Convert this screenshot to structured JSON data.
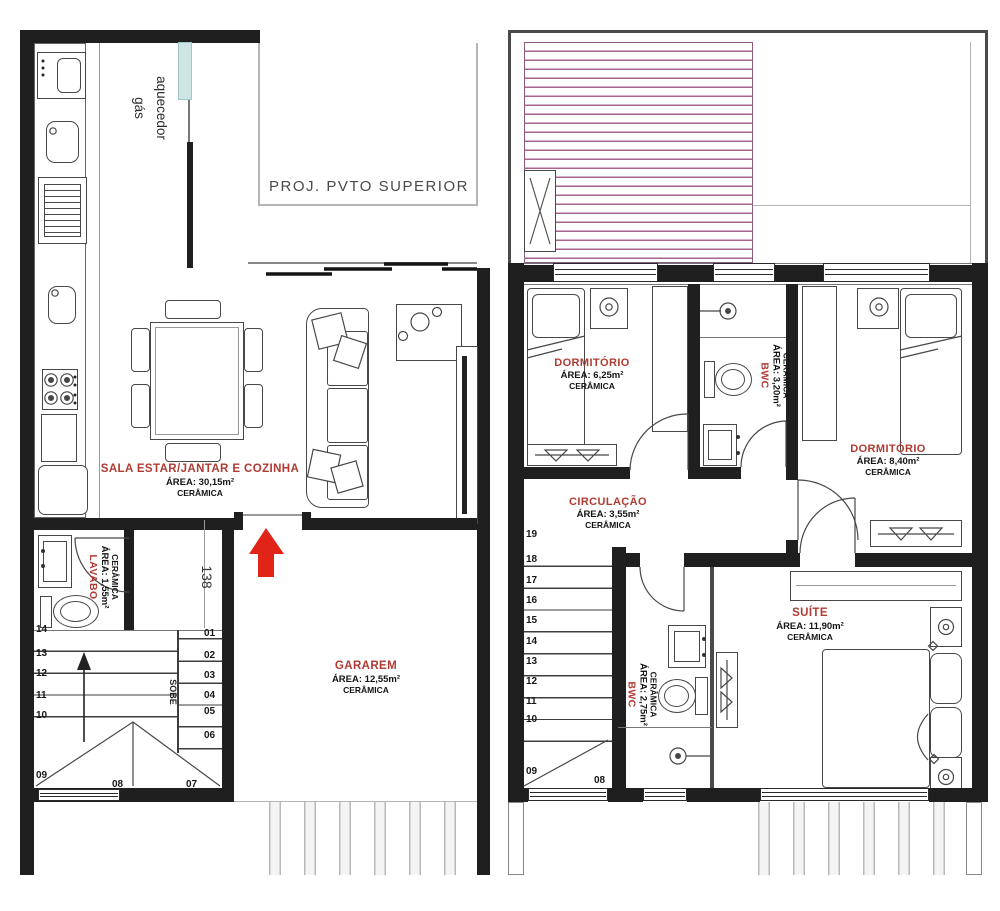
{
  "palette": {
    "label_red": "#b13b33",
    "wall": "#1f1f1f",
    "roof_hatch": "#a5638d",
    "arrow_red": "#e02418",
    "heater_teal": "#cfe4e4"
  },
  "ground": {
    "heater": {
      "l1": "aquecedor",
      "l2": "gás"
    },
    "proj": "PROJ.  PVTO  SUPERIOR",
    "sala": {
      "name": "SALA ESTAR/JANTAR E COZINHA",
      "area": "ÁREA:  30,15m²",
      "floor": "CERÂMICA"
    },
    "lavabo": {
      "name": "LAVABO",
      "area": "ÁREA: 1,55m²",
      "floor": "CERÂMICA"
    },
    "garagem": {
      "name": "GARAREM",
      "area": "ÁREA:  12,55m²",
      "floor": "CERÂMICA"
    },
    "dim": "138",
    "stair": {
      "sobe": "SOBE",
      "up": [
        "14",
        "13",
        "12",
        "11",
        "10"
      ],
      "down": [
        "01",
        "02",
        "03",
        "04",
        "05",
        "06"
      ],
      "winder": [
        "09",
        "08",
        "07"
      ]
    }
  },
  "upper": {
    "dorm1": {
      "name": "DORMITÓRIO",
      "area": "ÁREA:  6,25m²",
      "floor": "CERÂMICA"
    },
    "bwc1": {
      "name": "BWC",
      "area": "ÁREA: 3,20m²",
      "floor": "CERÂMICA"
    },
    "dorm2": {
      "name": "DORMITÓRIO",
      "area": "ÁREA:  8,40m²",
      "floor": "CERÂMICA"
    },
    "circulacao": {
      "name": "CIRCULAÇÃO",
      "area": "ÁREA:  3,55m²",
      "floor": "CERÂMICA"
    },
    "suite": {
      "name": "SUÍTE",
      "area": "ÁREA:  11,90m²",
      "floor": "CERÂMICA"
    },
    "bwc2": {
      "name": "BWC",
      "area": "ÁREA: 2,75m²",
      "floor": "CERÂMICA"
    },
    "stair": {
      "flight": [
        "19",
        "18",
        "17",
        "16",
        "15",
        "14",
        "13",
        "12",
        "11",
        "10"
      ],
      "winder": [
        "09",
        "08"
      ]
    }
  }
}
